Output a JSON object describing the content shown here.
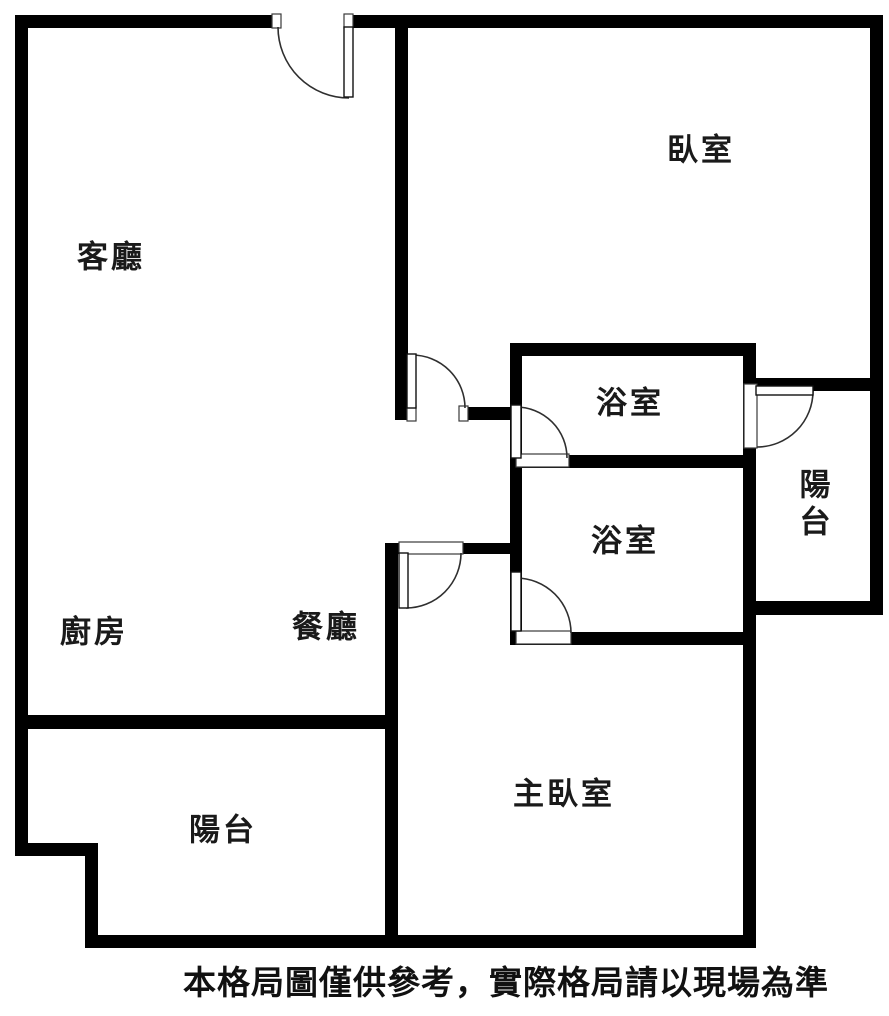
{
  "floor_plan": {
    "type": "apartment-floor-plan",
    "rooms": [
      {
        "id": "living-room",
        "label": "客廳"
      },
      {
        "id": "bedroom",
        "label": "臥室"
      },
      {
        "id": "bathroom-upper",
        "label": "浴室"
      },
      {
        "id": "balcony-right",
        "label": "陽台"
      },
      {
        "id": "bathroom-lower",
        "label": "浴室"
      },
      {
        "id": "kitchen",
        "label": "廚房"
      },
      {
        "id": "dining-room",
        "label": "餐廳"
      },
      {
        "id": "balcony-bottom",
        "label": "陽台"
      },
      {
        "id": "master-bedroom",
        "label": "主臥室"
      }
    ],
    "caption": "本格局圖僅供參考，實際格局請以現場為準",
    "colors": {
      "wall": "#000000",
      "background": "#ffffff",
      "label_text": "#1a1a1a",
      "door_line": "#2f2f2f"
    }
  }
}
